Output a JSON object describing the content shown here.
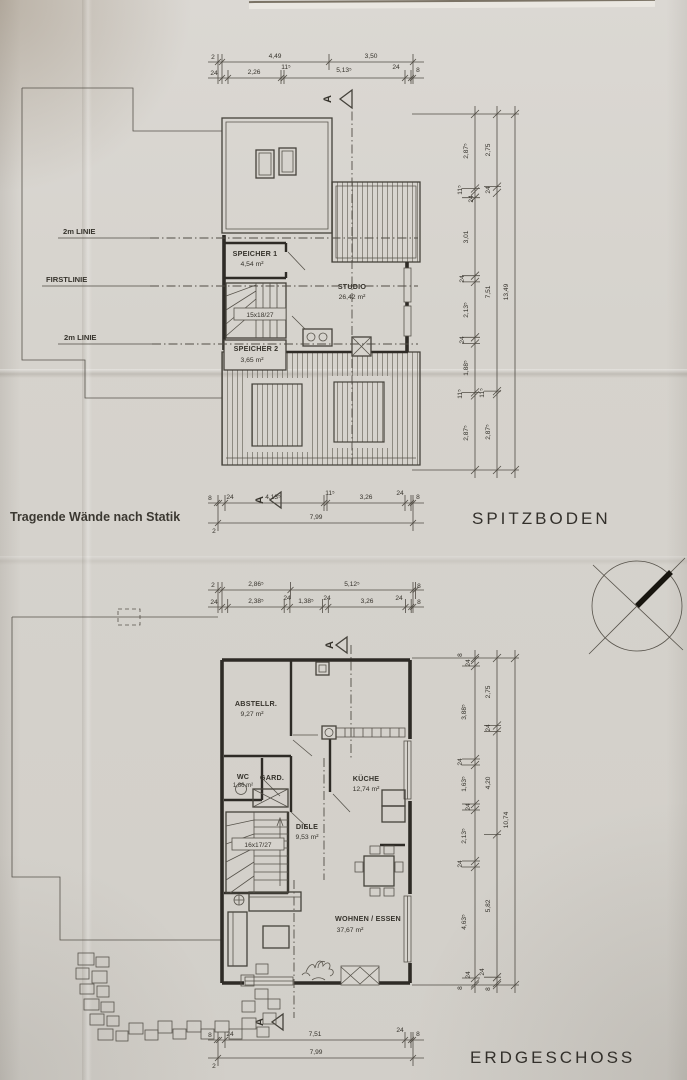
{
  "notes": {
    "statics": "Tragende Wände nach Statik"
  },
  "upper_plan": {
    "title": "SPITZBODEN",
    "section_letter": "A",
    "leader_labels": [
      "2m LINIE",
      "FIRSTLINIE",
      "2m LINIE"
    ],
    "rooms": {
      "speicher1": {
        "name": "SPEICHER 1",
        "area": "4,54 m²"
      },
      "studio": {
        "name": "STUDIO",
        "area": "26,42 m²"
      },
      "speicher2": {
        "name": "SPEICHER 2",
        "area": "3,65 m²"
      }
    },
    "stair_label": "15x18/27",
    "dims": {
      "top_row1": [
        "2",
        "4,49",
        "3,50"
      ],
      "top_row2": [
        "24",
        "2,26",
        "11⁵",
        "5,13⁵",
        "24",
        "8"
      ],
      "right_inner": [
        "2,87⁵",
        "11⁵",
        "24",
        "3,01",
        "24",
        "2,13⁵",
        "24",
        "1,88⁵",
        "11⁵",
        "2,87⁵"
      ],
      "right_mid": [
        "2,75",
        "24",
        "7,51",
        "11⁵",
        "2,87⁵"
      ],
      "right_total": "13,49",
      "bottom_row1": [
        "8",
        "24",
        "4,13⁵",
        "11⁵",
        "3,26",
        "24",
        "8"
      ],
      "bottom_row2": [
        "2",
        "7,99"
      ]
    }
  },
  "lower_plan": {
    "title": "ERDGESCHOSS",
    "section_letter": "A",
    "rooms": {
      "abstellraum": {
        "name": "ABSTELLR.",
        "area": "9,27 m²"
      },
      "wc": {
        "name": "WC",
        "area": "1,86 m²"
      },
      "garderobe": {
        "name": "GARD."
      },
      "kueche": {
        "name": "KÜCHE",
        "area": "12,74 m²"
      },
      "diele": {
        "name": "DIELE",
        "area": "9,53 m²"
      },
      "wohnen_essen": {
        "name": "WOHNEN / ESSEN",
        "area": "37,67 m²"
      }
    },
    "stair_label": "16x17/27",
    "dims": {
      "top_row1": [
        "2",
        "2,86⁵",
        "5,12⁵",
        "8"
      ],
      "top_row2": [
        "24",
        "2,38⁵",
        "24",
        "1,38⁵",
        "24",
        "3,26",
        "24",
        "8"
      ],
      "right_inner": [
        "8",
        "24",
        "3,88⁵",
        "24",
        "1,63⁵",
        "24",
        "2,13⁵",
        "24",
        "4,63⁵",
        "24",
        "8"
      ],
      "right_mid": [
        "2,75",
        "24",
        "4,20",
        "5,82",
        "24",
        "8"
      ],
      "right_total": "10,74",
      "bottom_row1": [
        "8",
        "24",
        "7,51",
        "24",
        "8"
      ],
      "bottom_row2": [
        "2",
        "7,99"
      ]
    }
  }
}
